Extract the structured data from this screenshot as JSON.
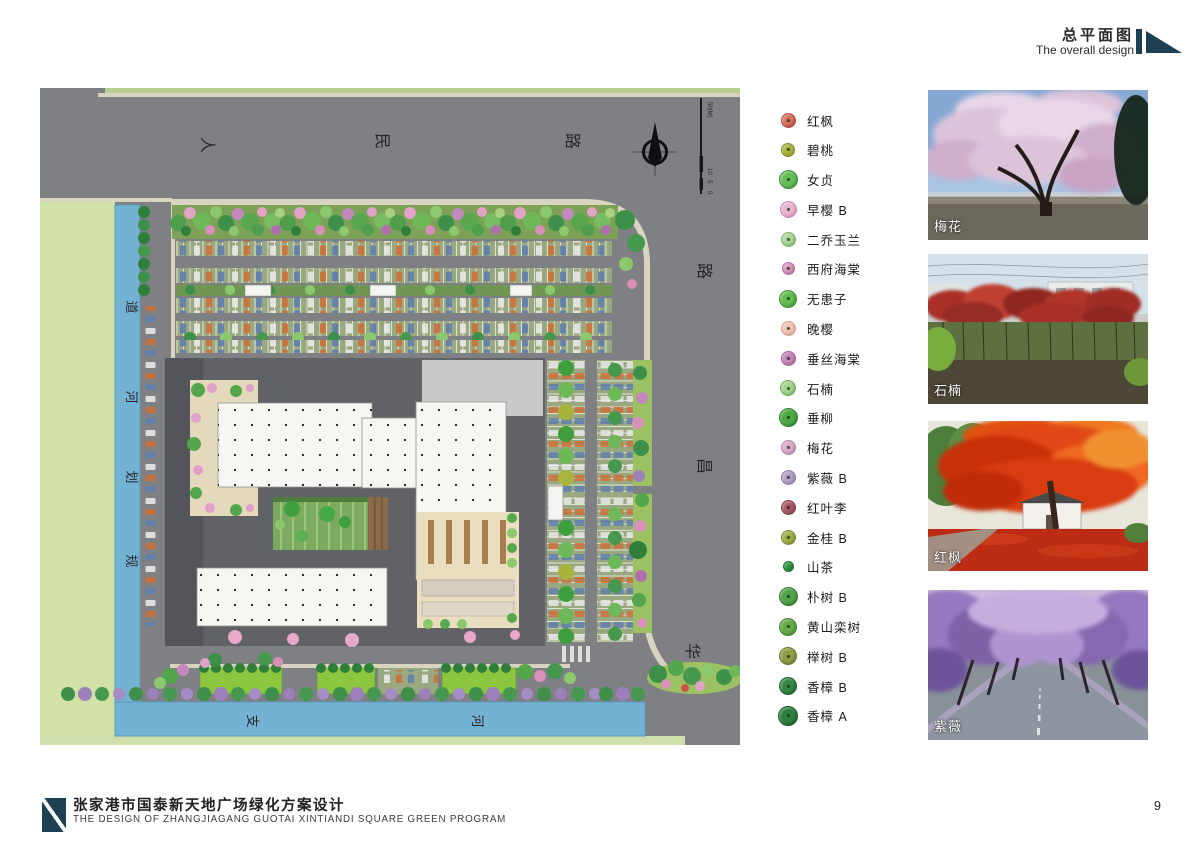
{
  "header": {
    "title_cn": "总平面图",
    "title_en": "The overall design"
  },
  "plan": {
    "labels": {
      "top": [
        "人",
        "民",
        "路"
      ],
      "right": [
        "路",
        "昌",
        "华"
      ],
      "left": [
        "道",
        "河",
        "划",
        "规"
      ],
      "bottom": [
        "支",
        "河"
      ]
    },
    "scale_ticks": [
      "50(M)",
      "10",
      "5",
      "0"
    ]
  },
  "legend": {
    "items": [
      {
        "label": "红枫",
        "color": "#d9705f",
        "edge": "#b04a40",
        "size": 13,
        "mark": "dot"
      },
      {
        "label": "碧桃",
        "color": "#a9b43c",
        "edge": "#87922c",
        "size": 12,
        "mark": "dot"
      },
      {
        "label": "女贞",
        "color": "#67bd57",
        "edge": "#3f9040",
        "size": 17,
        "mark": "dot"
      },
      {
        "label": "早樱 B",
        "color": "#e7b3d1",
        "edge": "#cc8cb6",
        "size": 15,
        "mark": "dot"
      },
      {
        "label": "二乔玉兰",
        "color": "#aed698",
        "edge": "#7fb06d",
        "size": 13,
        "mark": "dot"
      },
      {
        "label": "西府海棠",
        "color": "#d795bd",
        "edge": "#b46f9e",
        "size": 11,
        "mark": "dot"
      },
      {
        "label": "无患子",
        "color": "#63bb4e",
        "edge": "#3d9238",
        "size": 16,
        "mark": "dot"
      },
      {
        "label": "晚樱",
        "color": "#eec3b8",
        "edge": "#d69c8e",
        "size": 13,
        "mark": "dot"
      },
      {
        "label": "垂丝海棠",
        "color": "#c687b9",
        "edge": "#a25f97",
        "size": 13,
        "mark": "dot"
      },
      {
        "label": "石楠",
        "color": "#a2d48d",
        "edge": "#76ab62",
        "size": 14,
        "mark": "dot"
      },
      {
        "label": "垂柳",
        "color": "#4fa843",
        "edge": "#2e7f2f",
        "size": 17,
        "mark": "dot"
      },
      {
        "label": "梅花",
        "color": "#d9abcd",
        "edge": "#b483ac",
        "size": 13,
        "mark": "dot"
      },
      {
        "label": "紫薇 B",
        "color": "#b5a0cb",
        "edge": "#8f7cab",
        "size": 13,
        "mark": "dot"
      },
      {
        "label": "红叶李",
        "color": "#a85a64",
        "edge": "#823f4a",
        "size": 13,
        "mark": "dot"
      },
      {
        "label": "金桂 B",
        "color": "#9fae44",
        "edge": "#7d8a32",
        "size": 13,
        "mark": "dot"
      },
      {
        "label": "山茶",
        "color": "#2f9341",
        "edge": "#1e7230",
        "size": 9,
        "mark": "plain"
      },
      {
        "label": "朴树 B",
        "color": "#53a148",
        "edge": "#347c31",
        "size": 17,
        "mark": "dot"
      },
      {
        "label": "黄山栾树",
        "color": "#66a84a",
        "edge": "#458330",
        "size": 16,
        "mark": "dot"
      },
      {
        "label": "榉树 B",
        "color": "#8e9c42",
        "edge": "#6c7a30",
        "size": 16,
        "mark": "dot"
      },
      {
        "label": "香樟 B",
        "color": "#368544",
        "edge": "#1f5f30",
        "size": 16,
        "mark": "dot"
      },
      {
        "label": "香樟 A",
        "color": "#2e7f3d",
        "edge": "#1b5a2a",
        "size": 18,
        "mark": "dot"
      }
    ]
  },
  "photos": [
    {
      "label": "梅花"
    },
    {
      "label": "石楠"
    },
    {
      "label": "红枫"
    },
    {
      "label": "紫薇"
    }
  ],
  "footer": {
    "title_cn": "张家港市国泰新天地广场绿化方案设计",
    "title_en": "THE DESIGN OF ZHANGJIAGANG GUOTAI XINTIANDI SQUARE GREEN PROGRAM",
    "page": "9"
  },
  "colors": {
    "accent": "#1c3f52",
    "road_gray": "#7e8084",
    "canal_blue": "#74b2d4",
    "lawn_green": "#8cc63f"
  }
}
